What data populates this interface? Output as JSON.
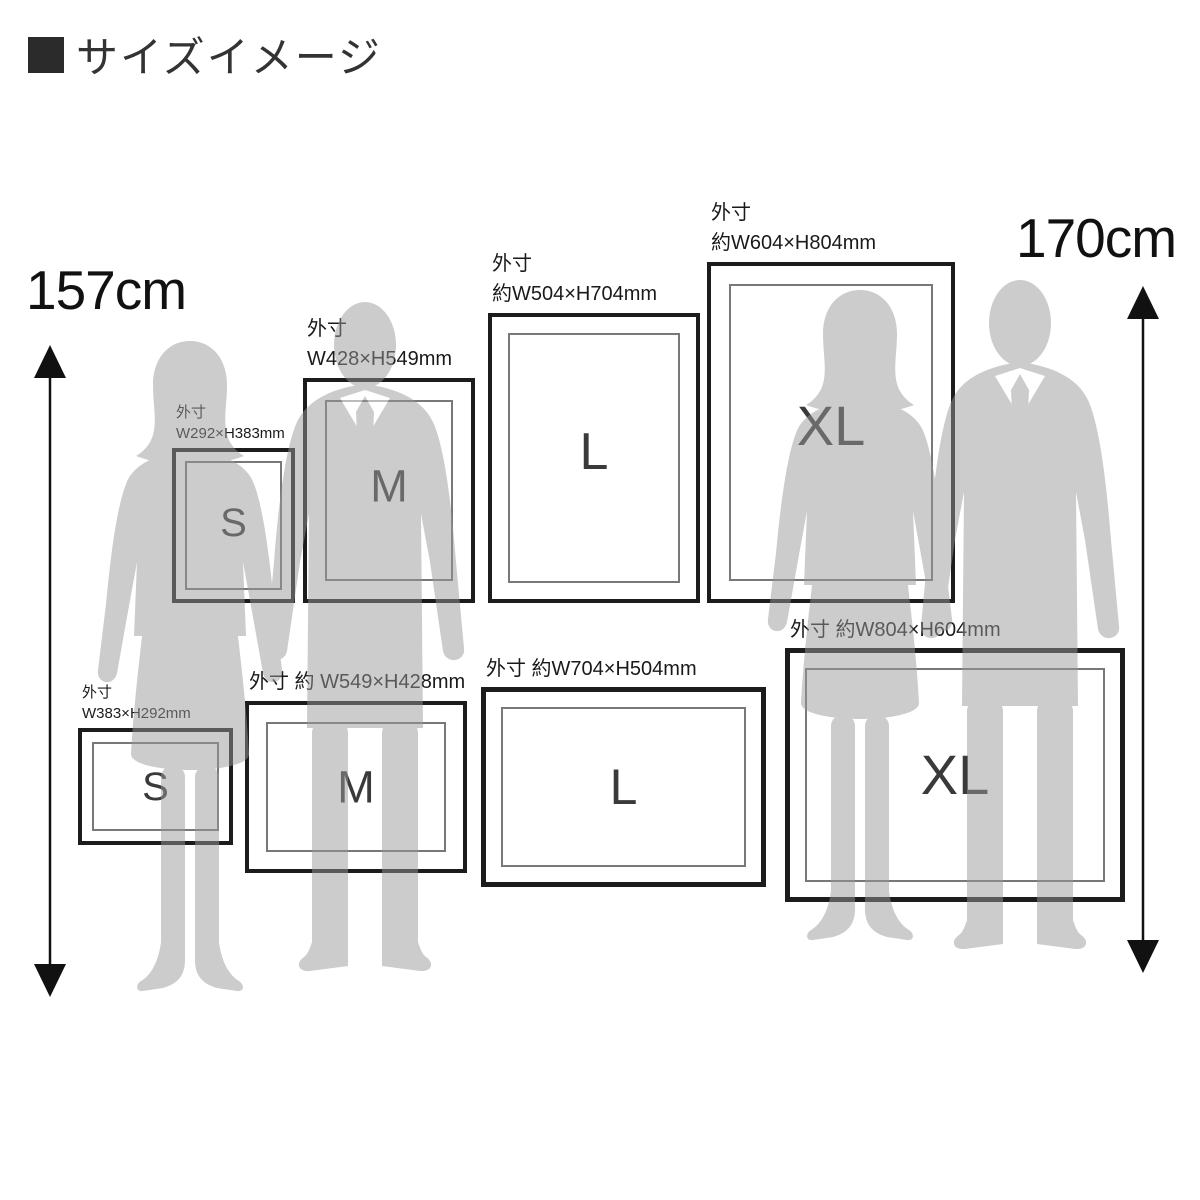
{
  "title": {
    "text": "サイズイメージ"
  },
  "measurements": {
    "left_height": "157cm",
    "right_height": "170cm"
  },
  "frames": {
    "s_portrait": {
      "letter": "S",
      "label_line1": "外寸",
      "label_line2": "W292×H383mm"
    },
    "m_portrait": {
      "letter": "M",
      "label_line1": "外寸",
      "label_line2": "W428×H549mm"
    },
    "l_portrait": {
      "letter": "L",
      "label_line1": "外寸",
      "label_line2": "約W504×H704mm"
    },
    "xl_portrait": {
      "letter": "XL",
      "label_line1": "外寸",
      "label_line2": "約W604×H804mm"
    },
    "s_landscape": {
      "letter": "S",
      "label_line1": "外寸",
      "label_line2": "W383×H292mm"
    },
    "m_landscape": {
      "letter": "M",
      "label_line1": "外寸 約 W549×H428mm",
      "label_line2": ""
    },
    "l_landscape": {
      "letter": "L",
      "label_line1": "外寸 約W704×H504mm",
      "label_line2": ""
    },
    "xl_landscape": {
      "letter": "XL",
      "label_line1": "外寸 約W804×H604mm",
      "label_line2": ""
    }
  },
  "icons": {
    "left_arrow": "double-headed-vertical-arrow",
    "right_arrow": "double-headed-vertical-arrow",
    "title_bullet": "filled-square"
  },
  "colors": {
    "frame_border": "#1c1c1c",
    "mat_line": "#787878",
    "silhouette": "#999999",
    "text_primary": "#1a1a1a",
    "letter_text": "#3a3a3a",
    "title_square": "#2b2b2b"
  }
}
